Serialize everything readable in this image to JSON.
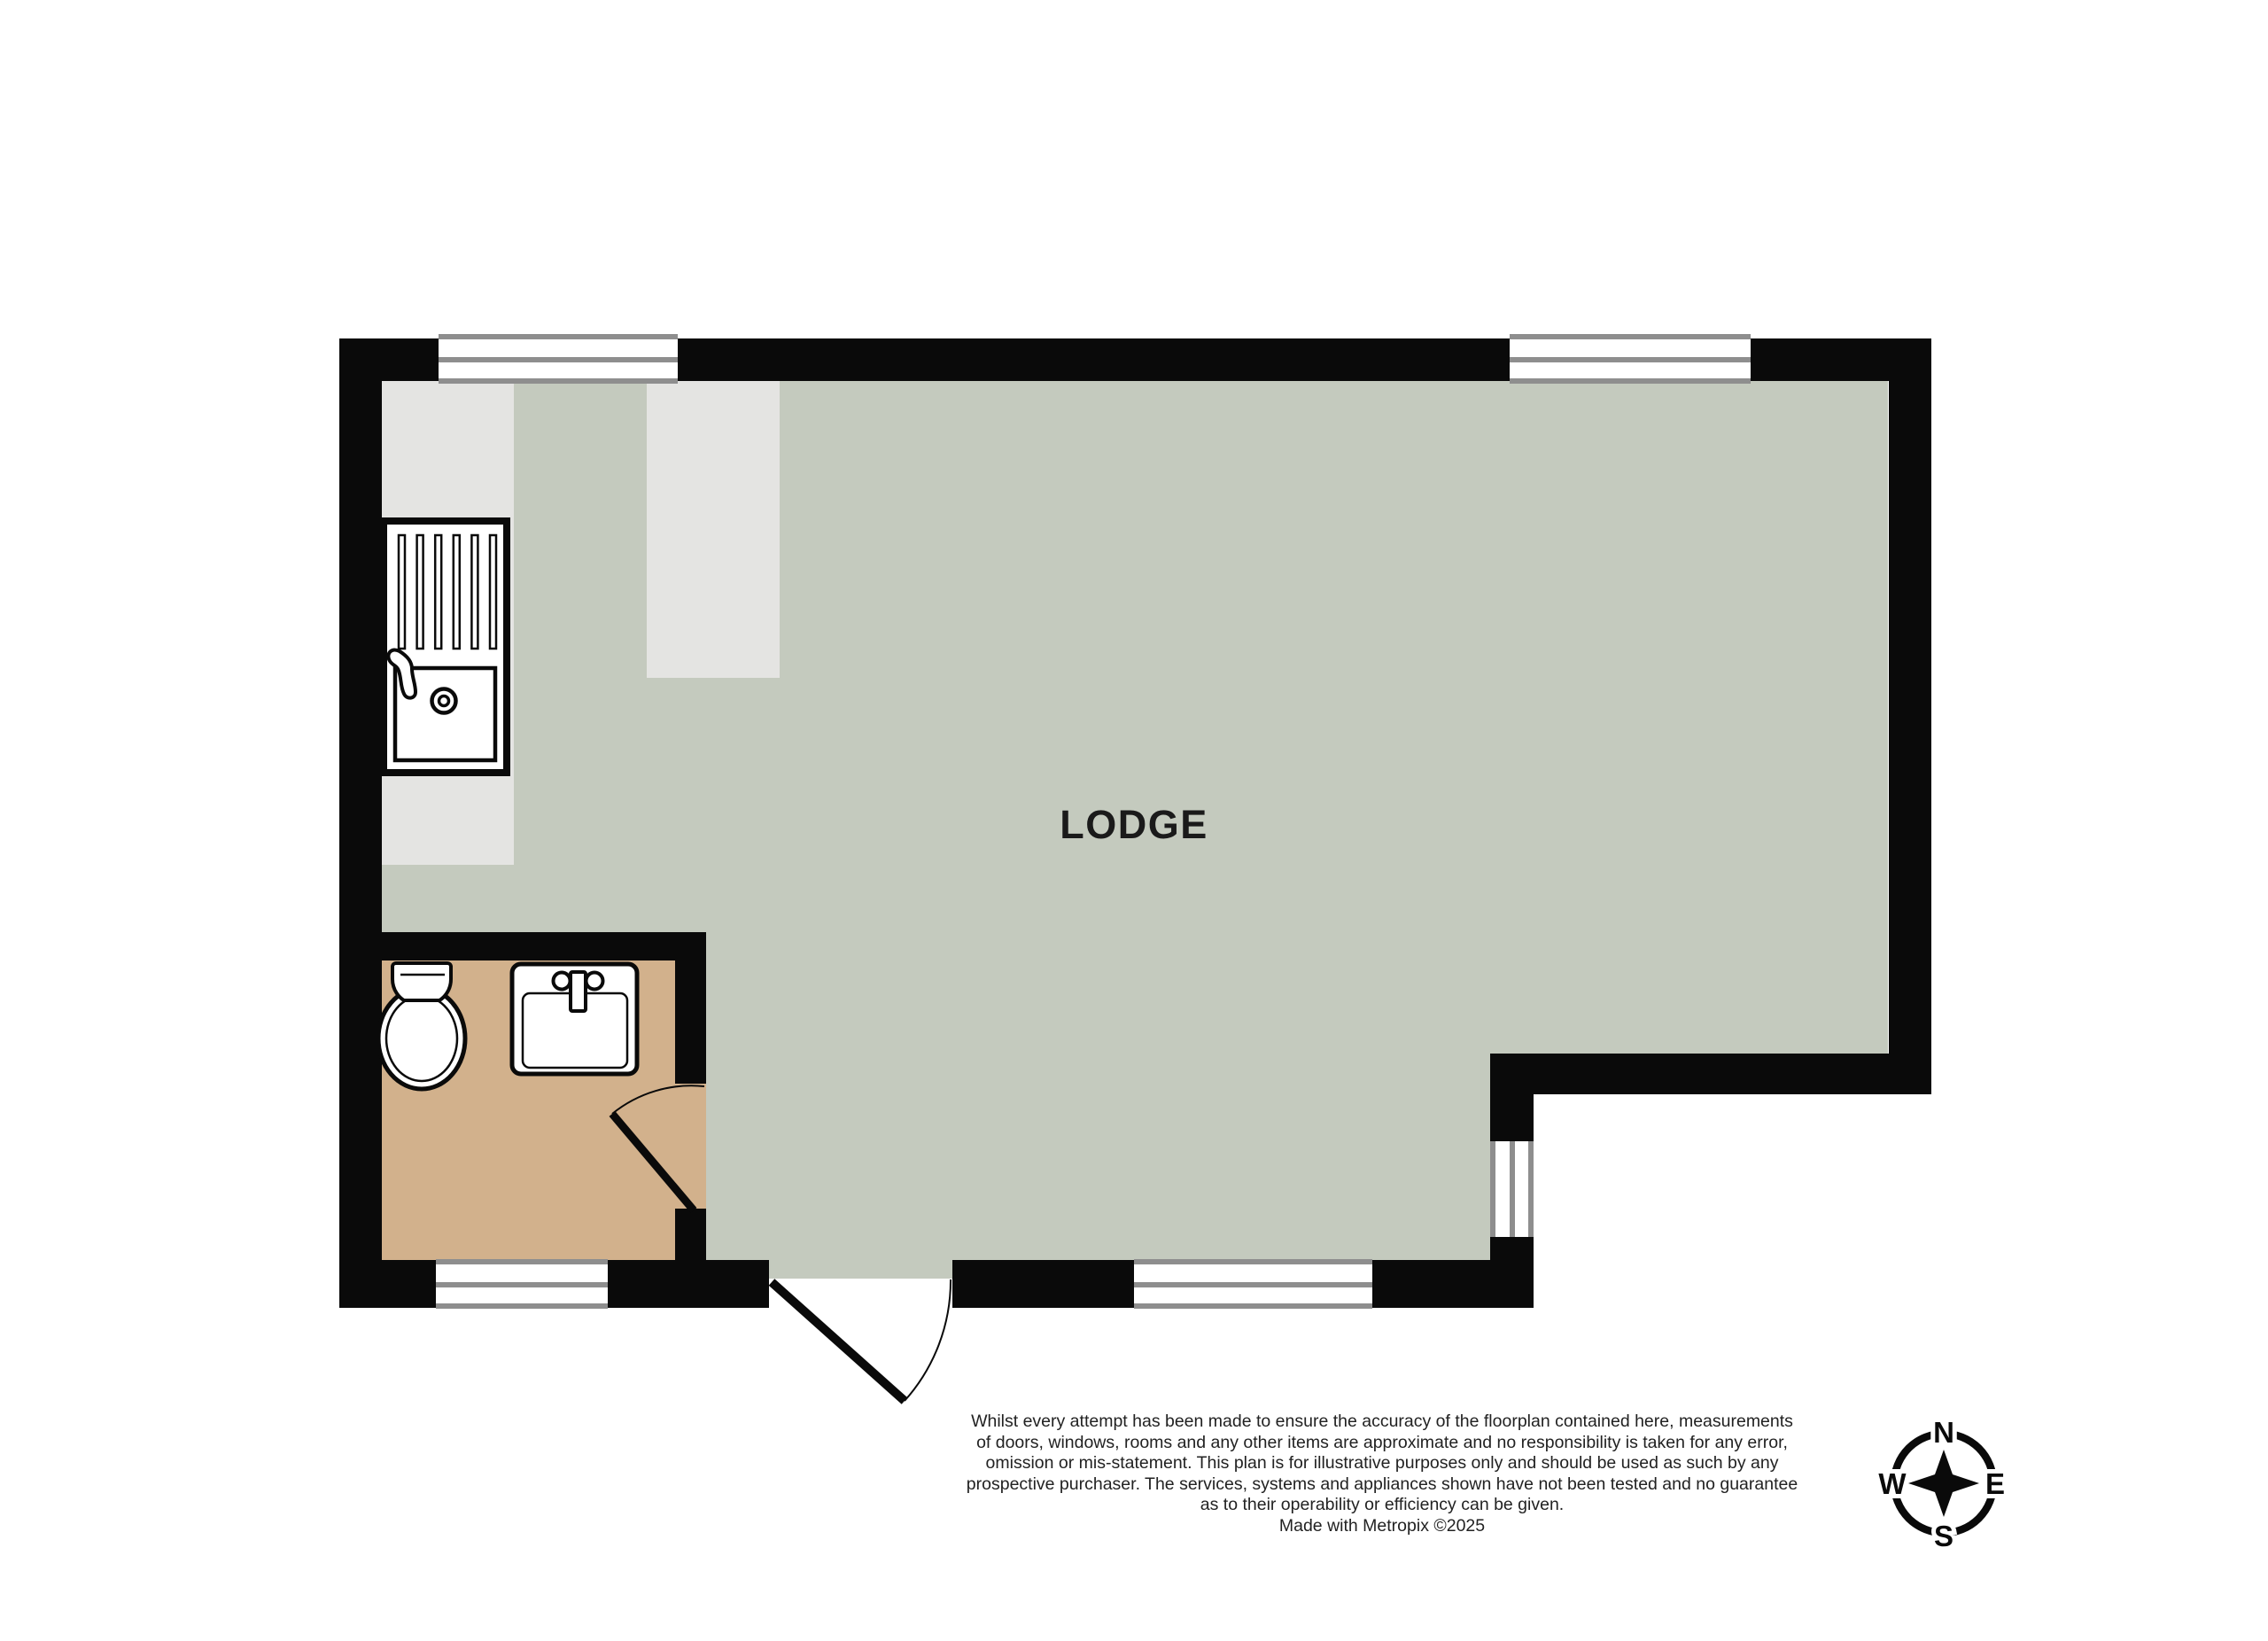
{
  "colors": {
    "wall": "#0a0a0a",
    "floor_main": "#c4cabe",
    "floor_bathroom": "#d2b18c",
    "counter": "#e4e4e2",
    "window_frame": "#8e8e8e",
    "window_fill": "#ffffff",
    "text": "#1a1a1a"
  },
  "rooms": [
    {
      "label": "LODGE"
    }
  ],
  "fixtures": [
    {
      "name": "kitchen-sink"
    },
    {
      "name": "toilet"
    },
    {
      "name": "bathroom-sink"
    }
  ],
  "compass": {
    "north": "N",
    "east": "E",
    "south": "S",
    "west": "W"
  },
  "footer": {
    "disclaimer_lines": [
      "Whilst every attempt has been made to ensure the accuracy of the floorplan contained here, measurements",
      "of doors, windows, rooms and any other items are approximate and no responsibility is taken for any error,",
      "omission or mis-statement. This plan is for illustrative purposes only and should be used as such by any",
      "prospective purchaser. The services, systems and appliances shown have not been tested and no guarantee",
      "as to their operability or efficiency can be given."
    ],
    "credit": "Made with Metropix ©2025"
  }
}
